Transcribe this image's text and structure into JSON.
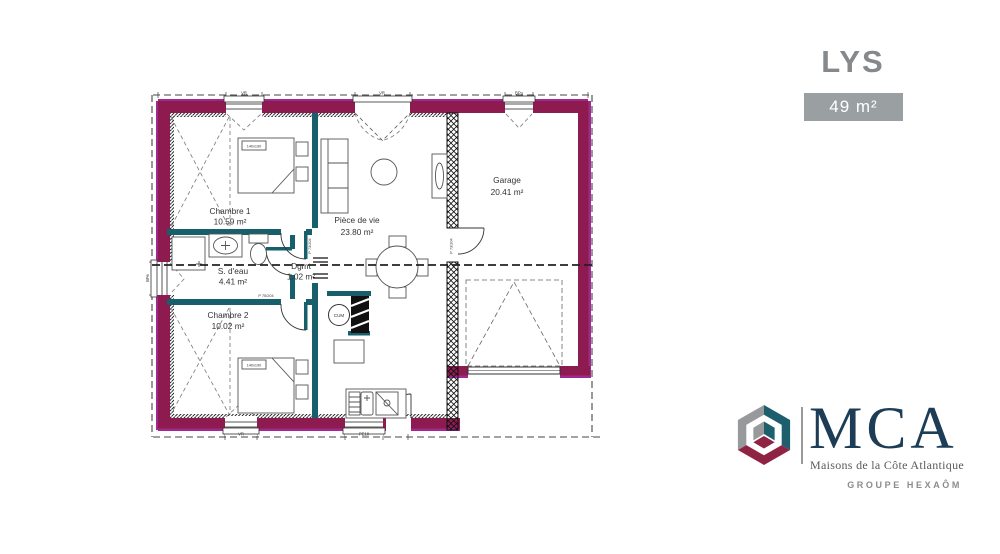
{
  "header": {
    "title": "LYS",
    "area_badge": "49 m²"
  },
  "plan": {
    "rooms": [
      {
        "name": "Chambre 1",
        "area": "10.59 m²"
      },
      {
        "name": "Pièce de vie",
        "area": "23.80 m²"
      },
      {
        "name": "Garage",
        "area": "20.41 m²"
      },
      {
        "name": "S. d'eau",
        "area": "4.41 m²"
      },
      {
        "name": "Dgmt",
        "area": "1.02 m²"
      },
      {
        "name": "Chambre 2",
        "area": "10.02 m²"
      }
    ],
    "equipment": {
      "water_heater": "CUM",
      "bed_size": "140x190"
    },
    "door_label": "P 73/204",
    "door_label_alt": "P 75/204",
    "window_labels": {
      "top": [
        "VR",
        "VR",
        "BPu"
      ],
      "bottom": [
        "VR",
        "PE10"
      ],
      "left": "BFe"
    },
    "colors": {
      "exterior_wall": "#8e1b4f",
      "exterior_edge": "#a1288e",
      "interior_wall": "#175f6b"
    }
  },
  "brand": {
    "name": "MCA",
    "tagline": "Maisons de la Côte Atlantique",
    "group": "GROUPE HEXAÔM",
    "colors": {
      "navy": "#1d3c55",
      "gray": "#97999b",
      "teal": "#1e5f6e",
      "maroon": "#8f2344"
    }
  }
}
